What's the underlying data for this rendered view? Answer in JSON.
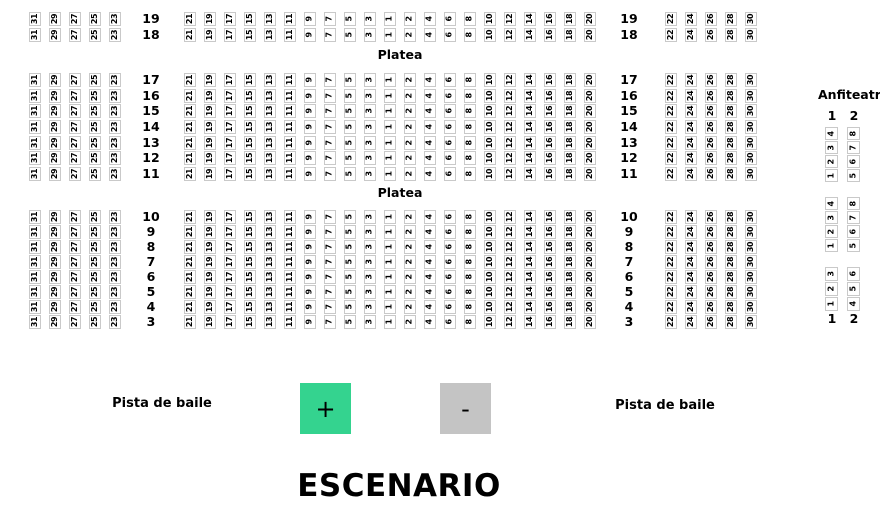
{
  "labels": {
    "platea": [
      "Platea",
      "Platea"
    ],
    "pista_de_baile": [
      "Pista de baile",
      "Pista de baile"
    ],
    "anfiteatro_title": "Anfiteatro",
    "escenario": "ESCENARIO"
  },
  "controls": {
    "zoom_in_label": "+",
    "zoom_out_label": "-",
    "zoom_in_color": "#34d38f",
    "zoom_out_color": "#c4c4c4"
  },
  "platea": {
    "bands": [
      {
        "rows": [
          19,
          18
        ]
      },
      {
        "rows": [
          17,
          16,
          15,
          14,
          13,
          12,
          11
        ]
      },
      {
        "rows": [
          10,
          9,
          8,
          7,
          6,
          5,
          4,
          3
        ]
      }
    ],
    "left_block_seat_numbers": [
      31,
      29,
      27,
      25,
      23
    ],
    "center_block_seat_numbers": [
      21,
      19,
      17,
      15,
      13,
      11,
      9,
      7,
      5,
      3,
      1,
      2,
      4,
      6,
      8,
      10,
      12,
      14,
      16,
      18,
      20
    ],
    "right_block_seat_numbers": [
      22,
      24,
      26,
      28,
      30
    ]
  },
  "anfiteatro": {
    "column_headers": [
      "1",
      "2"
    ],
    "column_footers": [
      "1",
      "2"
    ],
    "groups": [
      {
        "columns": [
          [
            4,
            3,
            2,
            1
          ],
          [
            8,
            7,
            6,
            5
          ]
        ]
      },
      {
        "columns": [
          [
            4,
            3,
            2,
            1
          ],
          [
            8,
            7,
            6,
            5
          ]
        ]
      },
      {
        "columns": [
          [
            3,
            2,
            1
          ],
          [
            6,
            5,
            4
          ]
        ]
      }
    ]
  },
  "colors": {
    "seat_fill": "#ffffff",
    "seat_border": "#c9c9c9",
    "text": "#000000",
    "background": "#ffffff"
  }
}
